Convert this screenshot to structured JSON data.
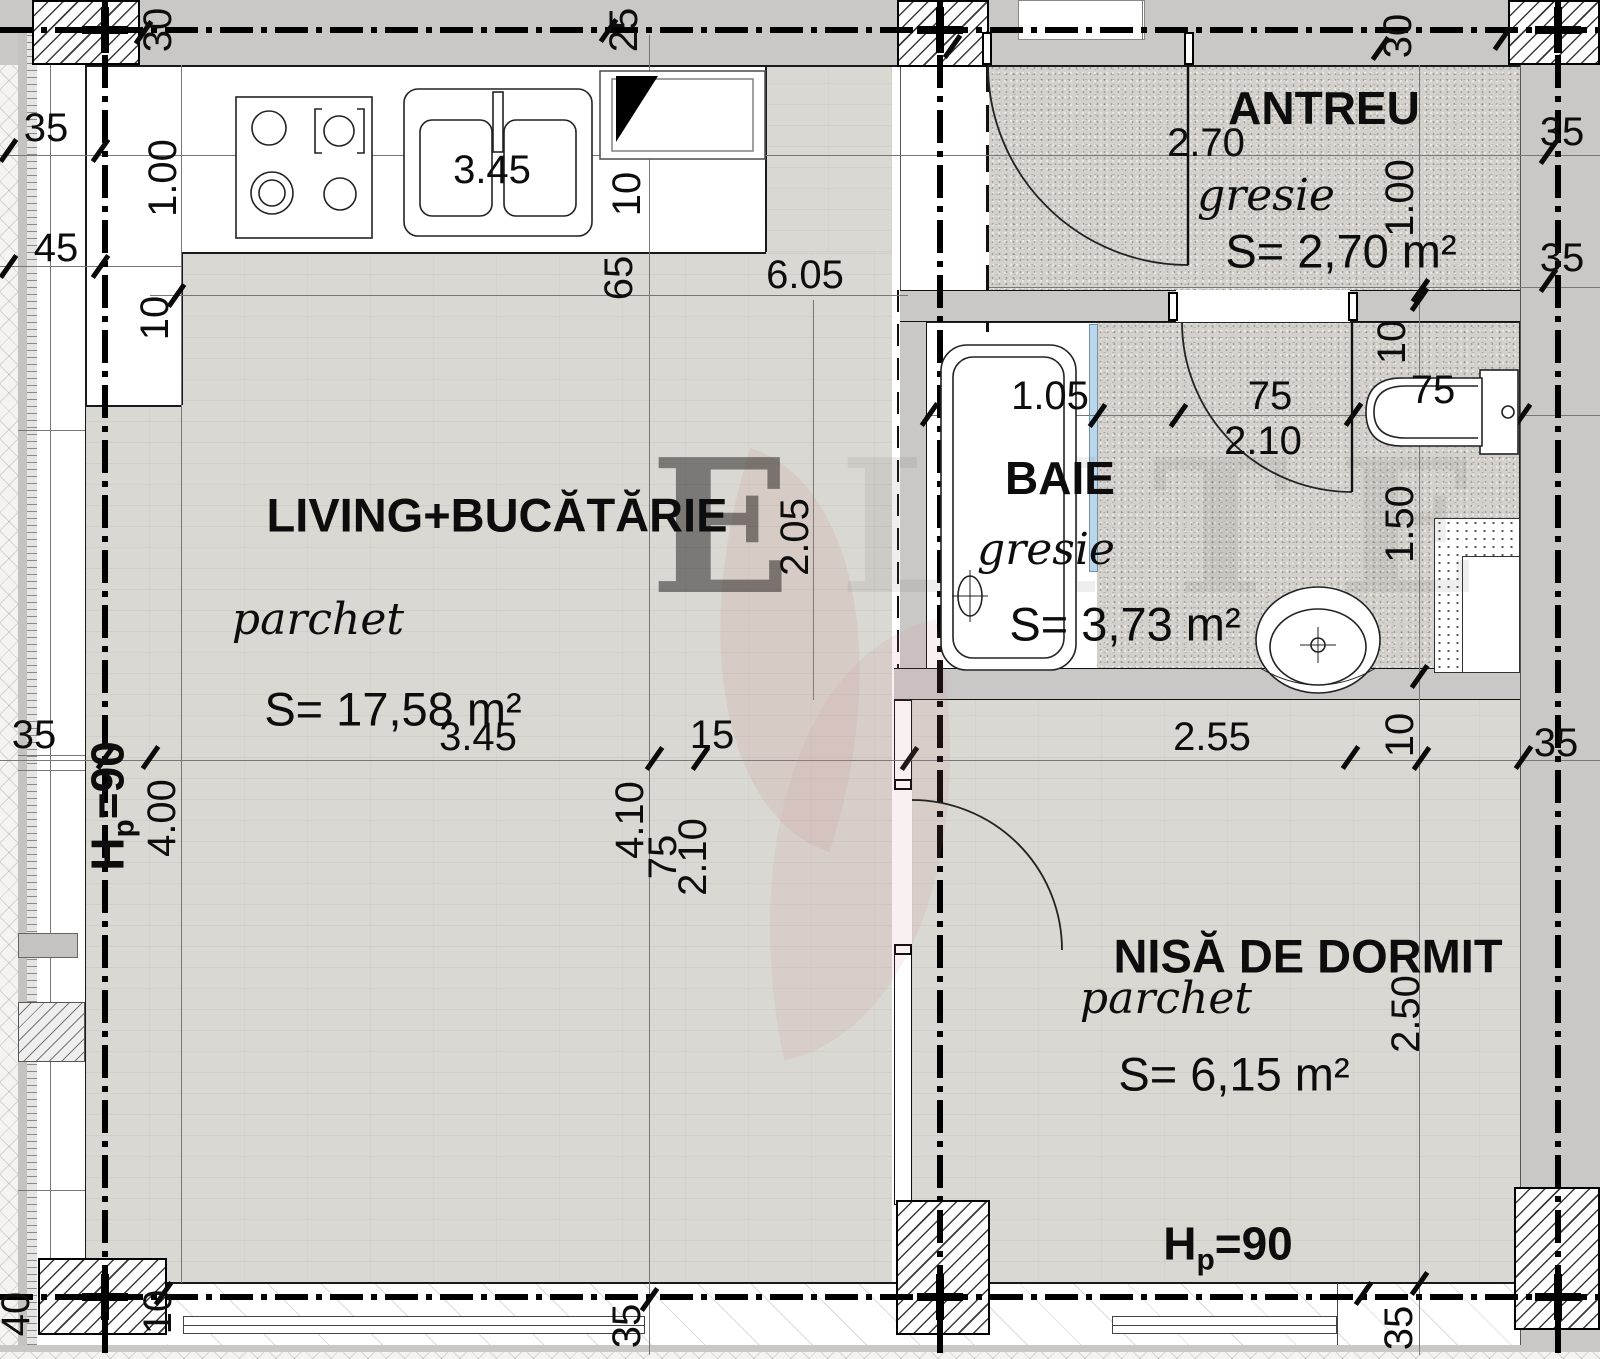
{
  "plan_title": "Apartment floor plan",
  "rooms": {
    "living": {
      "title": "LIVING+BUCĂTĂRIE",
      "floor": "parchet",
      "area": "S= 17,58 m²"
    },
    "antreu": {
      "title": "ANTREU",
      "floor": "gresie",
      "area": "S= 2,70 m²"
    },
    "baie": {
      "title": "BAIE",
      "floor": "gresie",
      "area": "S= 3,73 m²"
    },
    "nisa": {
      "title": "NISĂ DE DORMIT",
      "floor": "parchet",
      "area": "S= 6,15 m²"
    }
  },
  "labels": {
    "top_30_left": "30",
    "top_25": "25",
    "top_30_right": "30",
    "left_35": "35",
    "left_45": "45",
    "left_1_00": "1.00",
    "left_10": "10",
    "mid_10": "10",
    "mid_65": "65",
    "dim_6_05": "6.05",
    "sink_3_45": "3.45",
    "antreu_2_70": "2.70",
    "right_35_a": "35",
    "right_35_b": "35",
    "right_1_00": "1.00",
    "baie_1_05": "1.05",
    "door_75": "75",
    "door_2_10": "2.10",
    "toilet_75": "75",
    "right_10_top": "10",
    "right_1_50": "1.50",
    "dim_2_05": "2.05",
    "chain_35_l": "35",
    "chain_3_45": "3.45",
    "chain_15": "15",
    "chain_2_55": "2.55",
    "chain_10": "10",
    "chain_35_r": "35",
    "dim_4_00": "4.00",
    "dim_4_10": "4.10",
    "nisa_door_75": "75",
    "nisa_door_2_10": "2.10",
    "dim_2_50": "2.50",
    "hp_H": "H",
    "hp_p": "p",
    "hp_rest": "=90",
    "bottom_40": "40",
    "bottom_10": "10",
    "bottom_35_a": "35",
    "bottom_35_b": "35"
  },
  "watermark": {
    "first": "E",
    "rest": "LITE"
  },
  "colors": {
    "wall": "#c9c8c6",
    "parquet": "#d9d8d2",
    "gresie": "#d4d1cc",
    "line": "#000000",
    "tub_edge": "#b9d6ea"
  }
}
